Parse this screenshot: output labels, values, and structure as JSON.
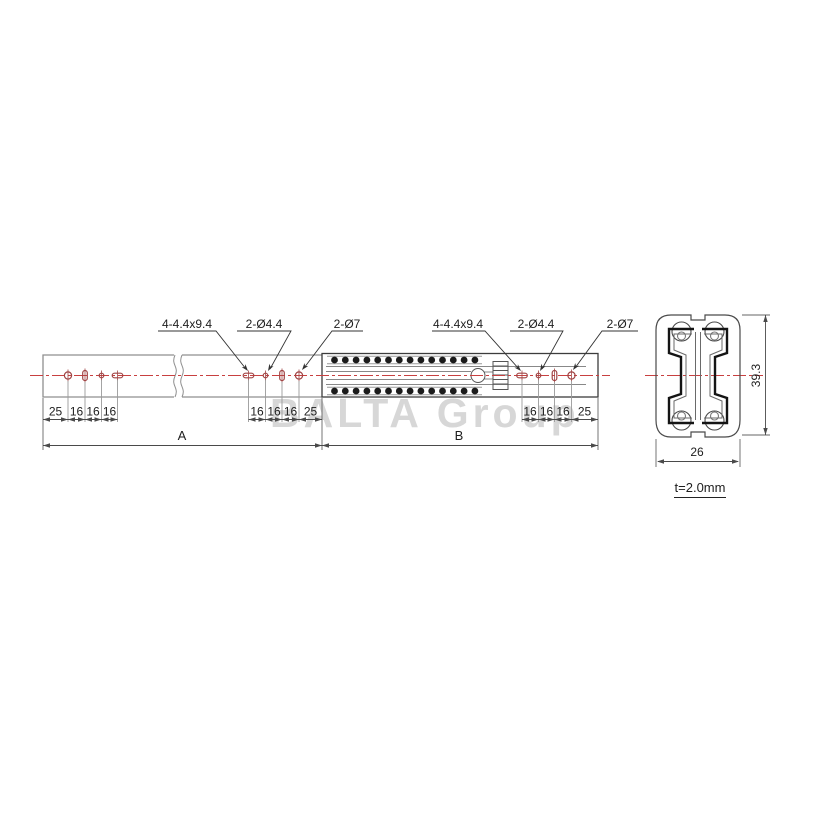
{
  "watermark": "BALTA Group",
  "callouts": {
    "left": {
      "slot": "4-4.4x9.4",
      "small_hole": "2-Ø4.4",
      "large_hole": "2-Ø7"
    },
    "right": {
      "slot": "4-4.4x9.4",
      "small_hole": "2-Ø4.4",
      "large_hole": "2-Ø7"
    }
  },
  "dims": {
    "group_a_left": [
      "25",
      "16",
      "16",
      "16"
    ],
    "group_a_right": [
      "16",
      "16",
      "16",
      "25"
    ],
    "group_b_right": [
      "16",
      "16",
      "16",
      "25"
    ],
    "length_a": "A",
    "length_b": "B",
    "section_height": "39.3",
    "section_width": "26",
    "wall_thickness": "t=2.0mm"
  },
  "colors": {
    "centerline_red": "#c84040",
    "hole_red": "#a04545",
    "rail_gray": "#8f8f8f",
    "rail_dark": "#3c3c3c",
    "dim_line": "#4a4a4a",
    "watermark_gray": "#d7d7d7"
  }
}
